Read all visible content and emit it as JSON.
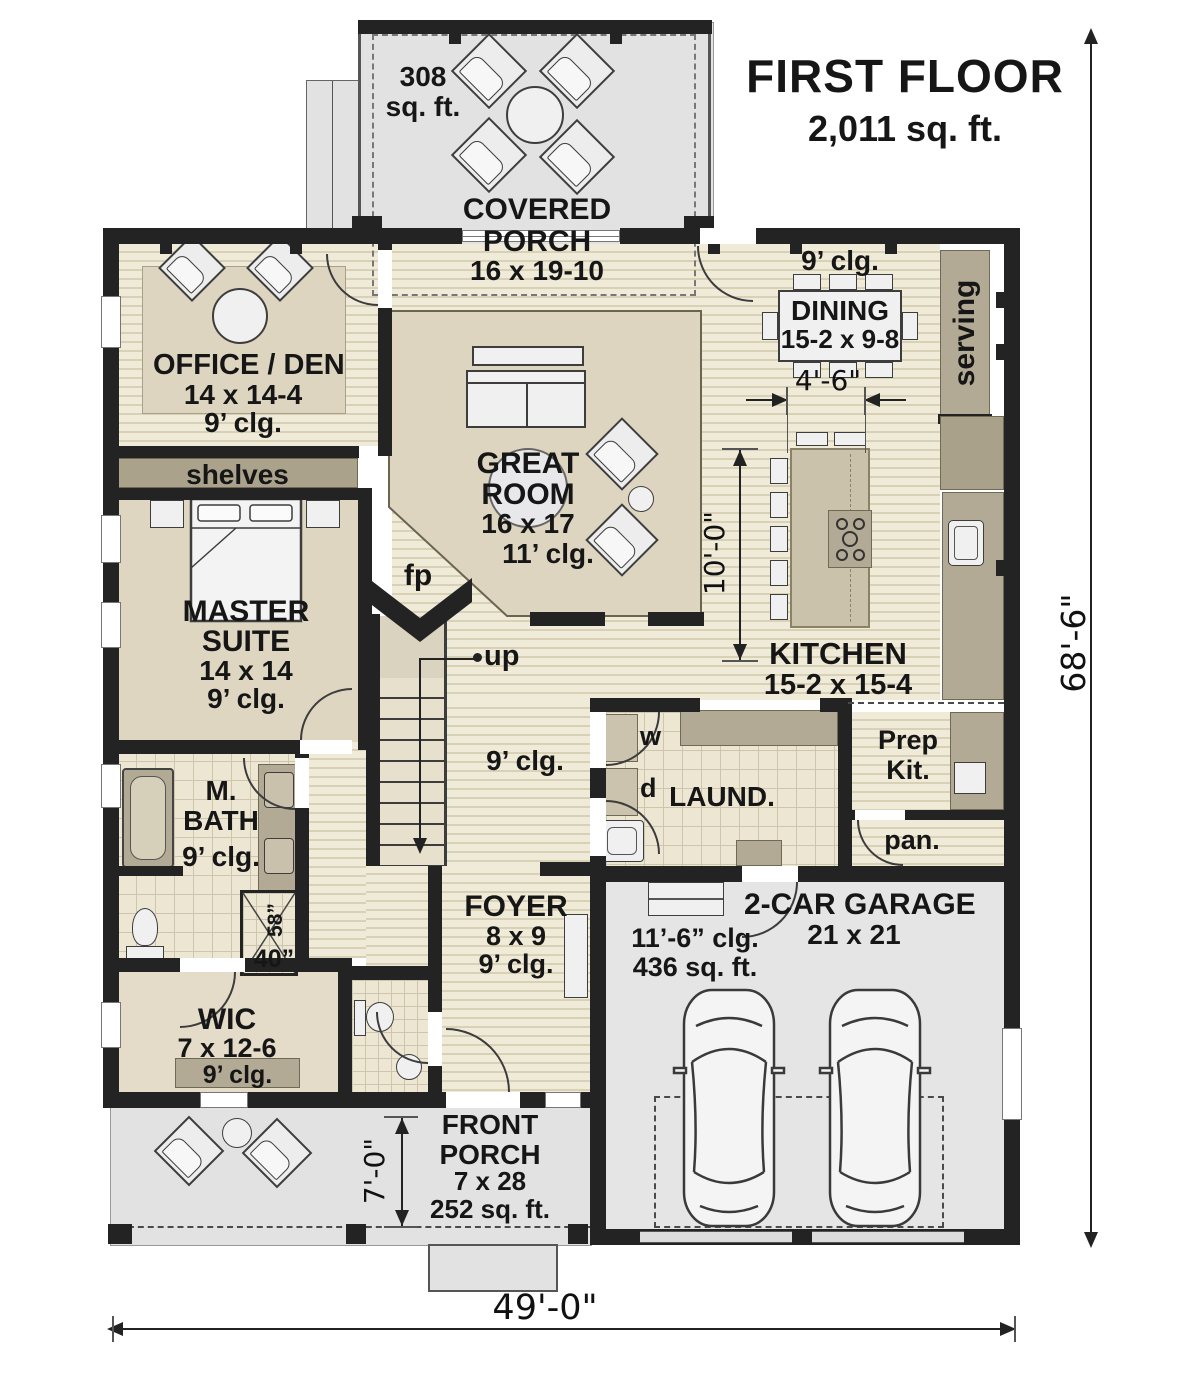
{
  "title": {
    "line1": "FIRST FLOOR",
    "line2": "2,011 sq. ft."
  },
  "covered_porch": {
    "area_num": "308",
    "area_unit": "sq. ft.",
    "name1": "COVERED",
    "name2": "PORCH",
    "dims": "16 x 19-10"
  },
  "office": {
    "name": "OFFICE / DEN",
    "dims": "14 x 14-4",
    "clg": "9’ clg."
  },
  "shelves": {
    "label": "shelves"
  },
  "dining": {
    "clg": "9’ clg.",
    "name": "DINING",
    "dims": "15-2 x 9-8"
  },
  "serving": {
    "label": "serving"
  },
  "great_room": {
    "name1": "GREAT",
    "name2": "ROOM",
    "dims": "16 x 17",
    "clg": "11’ clg."
  },
  "fireplace": {
    "label": "fp"
  },
  "master": {
    "name1": "MASTER",
    "name2": "SUITE",
    "dims": "14 x 14",
    "clg": "9’ clg."
  },
  "stairs": {
    "label": "up"
  },
  "hall": {
    "clg": "9’ clg."
  },
  "kitchen": {
    "name": "KITCHEN",
    "dims": "15-2 x 15-4"
  },
  "prep": {
    "line1": "Prep",
    "line2": "Kit."
  },
  "pantry": {
    "label": "pan."
  },
  "laundry": {
    "name": "LAUND.",
    "washer": "w",
    "dryer": "d"
  },
  "mbath": {
    "name1": "M.",
    "name2": "BATH",
    "clg": "9’ clg."
  },
  "shower": {
    "width": "58”",
    "depth": "40”"
  },
  "wic": {
    "name": "WIC",
    "dims": "7 x 12-6",
    "clg": "9’ clg."
  },
  "foyer": {
    "name": "FOYER",
    "dims": "8 x 9",
    "clg": "9’ clg."
  },
  "garage": {
    "clg": "11’-6” clg.",
    "area": "436 sq. ft.",
    "name": "2-CAR GARAGE",
    "dims": "21 x 21"
  },
  "front_porch": {
    "name1": "FRONT",
    "name2": "PORCH",
    "dims": "7 x 28",
    "area": "252 sq. ft."
  },
  "dimensions": {
    "overall_width": "49'-0\"",
    "overall_height": "68'-6\"",
    "dining_gap": "4'-6\"",
    "island": "10'-0\"",
    "porch_depth": "7'-0\""
  },
  "colors": {
    "wall": "#232323",
    "wood": "#f0ead9",
    "wood_line": "#d8d1b6",
    "room_tan": "#ded6c1",
    "counter": "#b2aa94",
    "porch_gray": "#e2e2e2",
    "garage_gray": "#e5e5e5",
    "tile": "#ece6d3"
  }
}
